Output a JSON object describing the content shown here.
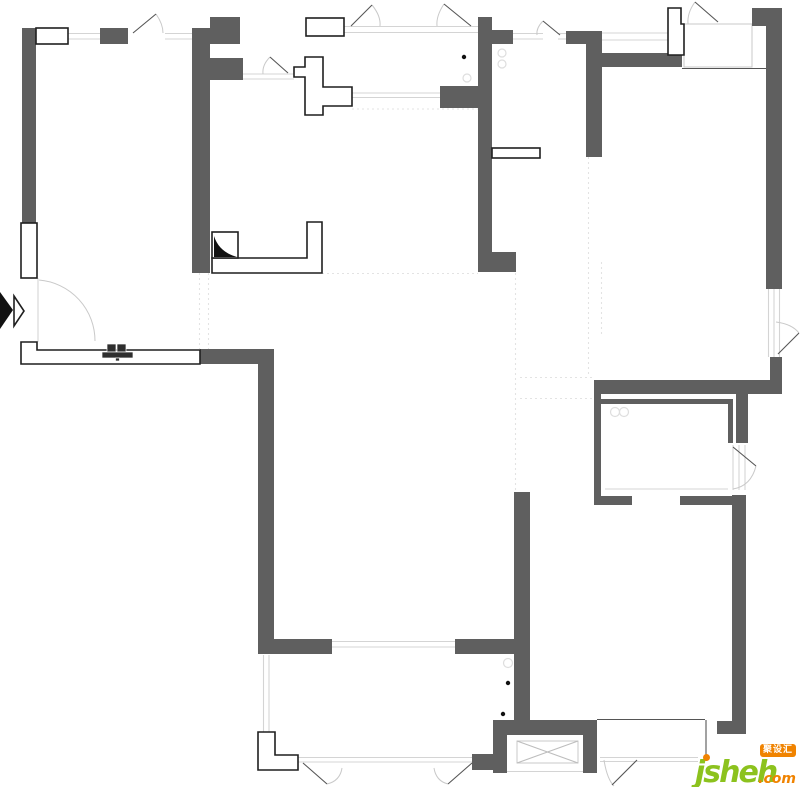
{
  "page": {
    "type": "residential-floor-plan",
    "background": "#ffffff"
  },
  "colors": {
    "wall": "#5f5f5f",
    "outline": "#1f1f1f",
    "faint": "#d4d4d4",
    "dashed": "#e3e3e3",
    "arc": "#c9c9c9",
    "leaf": "#555555",
    "black": "#111111",
    "brand_green": "#8cc21e",
    "brand_orange": "#f08300"
  },
  "watermark": {
    "brand": "jsheh",
    "tld": ".com",
    "badge": "聚设汇"
  },
  "plan": {
    "walls": [
      [
        22,
        28,
        14,
        195
      ],
      [
        100,
        28,
        28,
        16
      ],
      [
        192,
        28,
        18,
        245
      ],
      [
        210,
        17,
        30,
        27
      ],
      [
        210,
        58,
        33,
        22
      ],
      [
        478,
        17,
        14,
        255
      ],
      [
        492,
        30,
        21,
        14
      ],
      [
        440,
        86,
        38,
        22
      ],
      [
        478,
        252,
        38,
        20
      ],
      [
        566,
        31,
        36,
        13
      ],
      [
        586,
        31,
        16,
        126
      ],
      [
        602,
        53,
        80,
        14
      ],
      [
        752,
        8,
        30,
        18
      ],
      [
        766,
        8,
        16,
        281
      ],
      [
        770,
        357,
        12,
        25
      ],
      [
        594,
        380,
        188,
        14
      ],
      [
        594,
        380,
        7,
        125
      ],
      [
        600,
        399,
        133,
        5
      ],
      [
        728,
        399,
        5,
        44
      ],
      [
        736,
        394,
        12,
        49
      ],
      [
        594,
        496,
        38,
        9
      ],
      [
        680,
        496,
        53,
        9
      ],
      [
        732,
        495,
        14,
        239
      ],
      [
        717,
        721,
        15,
        13
      ],
      [
        200,
        349,
        74,
        15
      ],
      [
        258,
        362,
        16,
        292
      ],
      [
        274,
        639,
        58,
        15
      ],
      [
        455,
        639,
        59,
        15
      ],
      [
        514,
        492,
        16,
        228
      ],
      [
        493,
        720,
        104,
        15
      ],
      [
        493,
        735,
        14,
        38
      ],
      [
        583,
        735,
        14,
        38
      ],
      [
        472,
        754,
        21,
        16
      ]
    ],
    "white_polys": [
      {
        "name": "flue-duct",
        "pts": "305,57 323,57 323,87 352,87 352,106 323,106 323,115 305,115 305,77 294,77 294,67 305,67"
      },
      {
        "name": "corner-notch",
        "pts": "668,8 681,8 681,24 684,24 684,55 668,55"
      },
      {
        "name": "partition-corner",
        "pts": "212,258 307,258 307,222 322,222 322,273 212,273"
      },
      {
        "name": "hallway-partition",
        "pts": "21,342 37,342 37,350 200,350 200,364 21,364"
      },
      {
        "name": "balcony-step",
        "pts": "258,732 275,732 275,755 298,755 298,770 258,770"
      },
      {
        "name": "entry-chevron",
        "pts": "14,296 24,311 14,326"
      }
    ],
    "white_rects": [
      {
        "name": "window-box",
        "r": [
          36,
          28,
          32,
          16
        ]
      },
      {
        "name": "window-box",
        "r": [
          21,
          223,
          16,
          55
        ]
      },
      {
        "name": "window-box",
        "r": [
          306,
          18,
          38,
          18
        ]
      },
      {
        "name": "cabinet-box",
        "r": [
          212,
          232,
          26,
          26
        ]
      },
      {
        "name": "kitchen-counter-bar",
        "r": [
          492,
          148,
          48,
          10
        ]
      }
    ],
    "light_rects": [
      {
        "name": "bay-window",
        "r": [
          684,
          24,
          68,
          43
        ]
      },
      {
        "name": "shaft-box",
        "r": [
          517,
          741,
          61,
          22
        ]
      }
    ],
    "cross_lines": [
      [
        517,
        741,
        578,
        763
      ],
      [
        517,
        763,
        578,
        741
      ]
    ],
    "faint_lines": [
      [
        68,
        33.5,
        100,
        33.5
      ],
      [
        68,
        39,
        100,
        39
      ],
      [
        165,
        33.5,
        192,
        33.5
      ],
      [
        165,
        39,
        192,
        39
      ],
      [
        343,
        26.5,
        478,
        26.5
      ],
      [
        343,
        32.5,
        478,
        32.5
      ],
      [
        513,
        33.5,
        543,
        33.5
      ],
      [
        513,
        39,
        543,
        39
      ],
      [
        558,
        33.5,
        566,
        33.5
      ],
      [
        558,
        39,
        566,
        39
      ],
      [
        602,
        33,
        668,
        33
      ],
      [
        602,
        40,
        668,
        40
      ],
      [
        243,
        74,
        294,
        74
      ],
      [
        243,
        79,
        294,
        79
      ],
      [
        352,
        93,
        440,
        93
      ],
      [
        352,
        97.5,
        440,
        97.5
      ],
      [
        768.5,
        289,
        768.5,
        357
      ],
      [
        774,
        289,
        774,
        357
      ],
      [
        779.5,
        289,
        779.5,
        357
      ],
      [
        332,
        641.5,
        455,
        641.5
      ],
      [
        332,
        647,
        455,
        647
      ],
      [
        263.5,
        655,
        263.5,
        732
      ],
      [
        269,
        655,
        269,
        732
      ],
      [
        298,
        757.5,
        472,
        757.5
      ],
      [
        298,
        762,
        472,
        762
      ],
      [
        600,
        757.5,
        698,
        757.5
      ],
      [
        600,
        761.5,
        698,
        761.5
      ],
      [
        733,
        445,
        733,
        490
      ],
      [
        739,
        445,
        739,
        490
      ],
      [
        745,
        445,
        745,
        490
      ],
      [
        605,
        489,
        728,
        489
      ],
      [
        684,
        24.5,
        752,
        24.5
      ],
      [
        507,
        771.5,
        583,
        771.5
      ],
      [
        38,
        278,
        38,
        342
      ]
    ],
    "dark_lines": [
      [
        133,
        33,
        156,
        14
      ],
      [
        351,
        26,
        372,
        5
      ],
      [
        471,
        26,
        444,
        4
      ],
      [
        543,
        21,
        560,
        35
      ],
      [
        695,
        2,
        718,
        22
      ],
      [
        270,
        57,
        288,
        73
      ],
      [
        799,
        333,
        778,
        354
      ],
      [
        733,
        447,
        756,
        466
      ],
      [
        706,
        720,
        706,
        761
      ],
      [
        597,
        719.5,
        705,
        719.5
      ],
      [
        682,
        68.5,
        766,
        68.5
      ],
      [
        303,
        763,
        327,
        784
      ],
      [
        472,
        763,
        448,
        784
      ],
      [
        637,
        760,
        612,
        785
      ]
    ],
    "arcs": [
      "M156,14 Q163,24 163,33",
      "M372,5 Q381,16 380,26",
      "M444,4 Q436,16 437,26",
      "M543,21 Q536,28 537,35",
      "M695,2 Q687,13 688,24",
      "M270,57 Q262,65 263,74",
      "M39,280 A61,61 0 0 1 95,341",
      "M776,322 Q792,324 799,333",
      "M733,489 Q751,486 756,466",
      "M604,760 Q607,779 614,786",
      "M327,784 Q340,781 342,768",
      "M448,784 Q436,781 434,768"
    ],
    "dashed_lines": [
      [
        199.5,
        273,
        199.5,
        349
      ],
      [
        208.5,
        273,
        208.5,
        349
      ],
      [
        322,
        273.5,
        478,
        273.5
      ],
      [
        515.5,
        273,
        515.5,
        640
      ],
      [
        588.5,
        157,
        588.5,
        377
      ],
      [
        601.5,
        262,
        601.5,
        335
      ],
      [
        520,
        377.5,
        594,
        377.5
      ],
      [
        520,
        398.5,
        594,
        398.5
      ],
      [
        352,
        109,
        478,
        109
      ]
    ],
    "circles": [
      [
        502,
        53,
        4
      ],
      [
        502,
        64,
        4
      ],
      [
        467,
        78,
        4
      ],
      [
        615,
        412,
        4.5
      ],
      [
        624,
        412,
        4.5
      ],
      [
        508,
        663,
        4.5
      ]
    ],
    "dots": [
      [
        464,
        57,
        2.2
      ],
      [
        508,
        683,
        2.2
      ],
      [
        503,
        714,
        2.2
      ]
    ],
    "black_paths": [
      {
        "name": "entry-arrow",
        "d": "M0,292 L13,310 L0,329 Z"
      },
      {
        "name": "cabinet-door-fill",
        "d": "M214,257 L214,236 Q219,252 237,257 Z"
      }
    ],
    "fix_rects": [
      [
        107,
        344,
        9,
        8
      ],
      [
        117,
        344,
        9,
        8
      ],
      [
        102,
        352,
        31,
        6
      ],
      [
        115.5,
        358,
        4,
        3
      ]
    ]
  }
}
